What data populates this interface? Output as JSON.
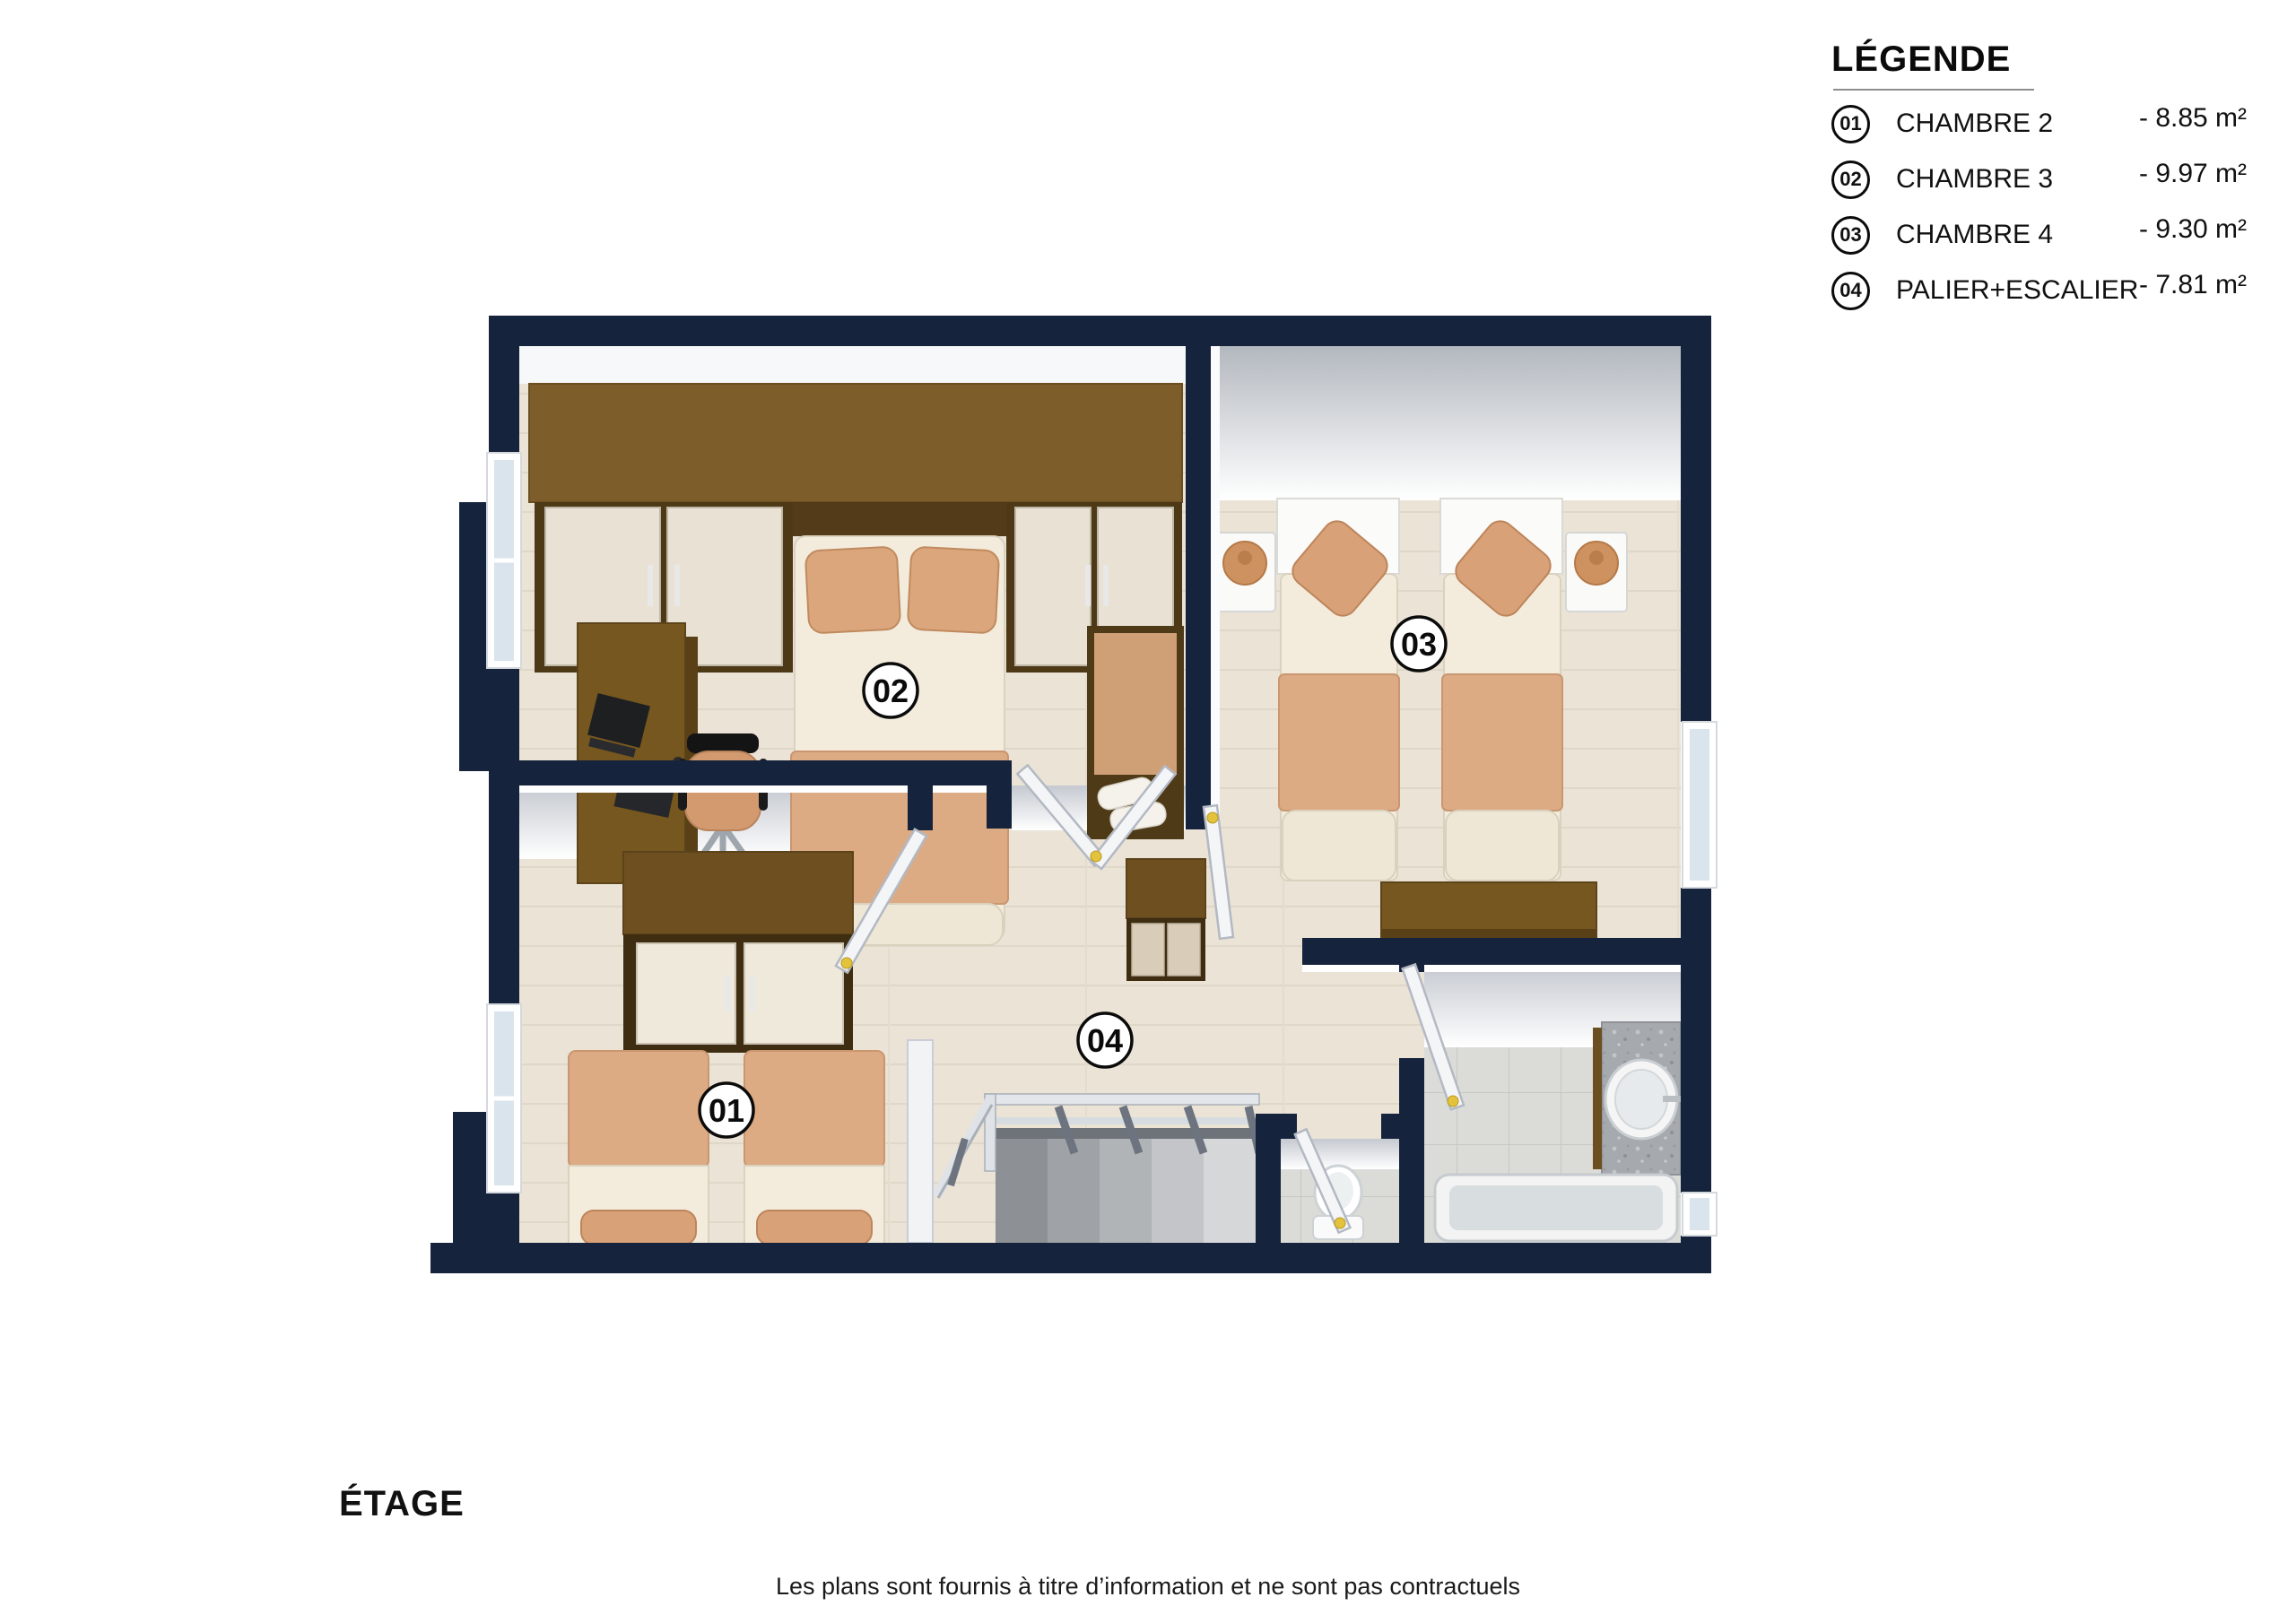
{
  "page": {
    "background": "#ffffff"
  },
  "legend": {
    "title": "LÉGENDE",
    "items": [
      {
        "num": "01",
        "label": "CHAMBRE 2",
        "area": "- 8.85 m²"
      },
      {
        "num": "02",
        "label": "CHAMBRE 3",
        "area": "- 9.97 m²"
      },
      {
        "num": "03",
        "label": "CHAMBRE 4",
        "area": "- 9.30 m²"
      },
      {
        "num": "04",
        "label": "PALIER+ESCALIER",
        "area": "- 7.81 m²"
      }
    ]
  },
  "plan": {
    "badges": [
      {
        "num": "01"
      },
      {
        "num": "02"
      },
      {
        "num": "03"
      },
      {
        "num": "04"
      }
    ],
    "colors": {
      "exterior_wall": "#16233C",
      "interior_wall_face": "#F2F3F5",
      "floor_wood": "#EAE3D6",
      "floor_tile": "#DBDBD8",
      "furniture_wood_dark": "#4E3917",
      "furniture_wood": "#7D5E2B",
      "fabric_tan": "#D9A178",
      "fabric_cream": "#F3ECDC",
      "window_glass": "#D9E4EC",
      "door_handle": "#E4C33C"
    }
  },
  "footer": {
    "floor_label": "ÉTAGE",
    "disclaimer": "Les plans sont fournis à titre d’information et ne sont pas contractuels"
  }
}
